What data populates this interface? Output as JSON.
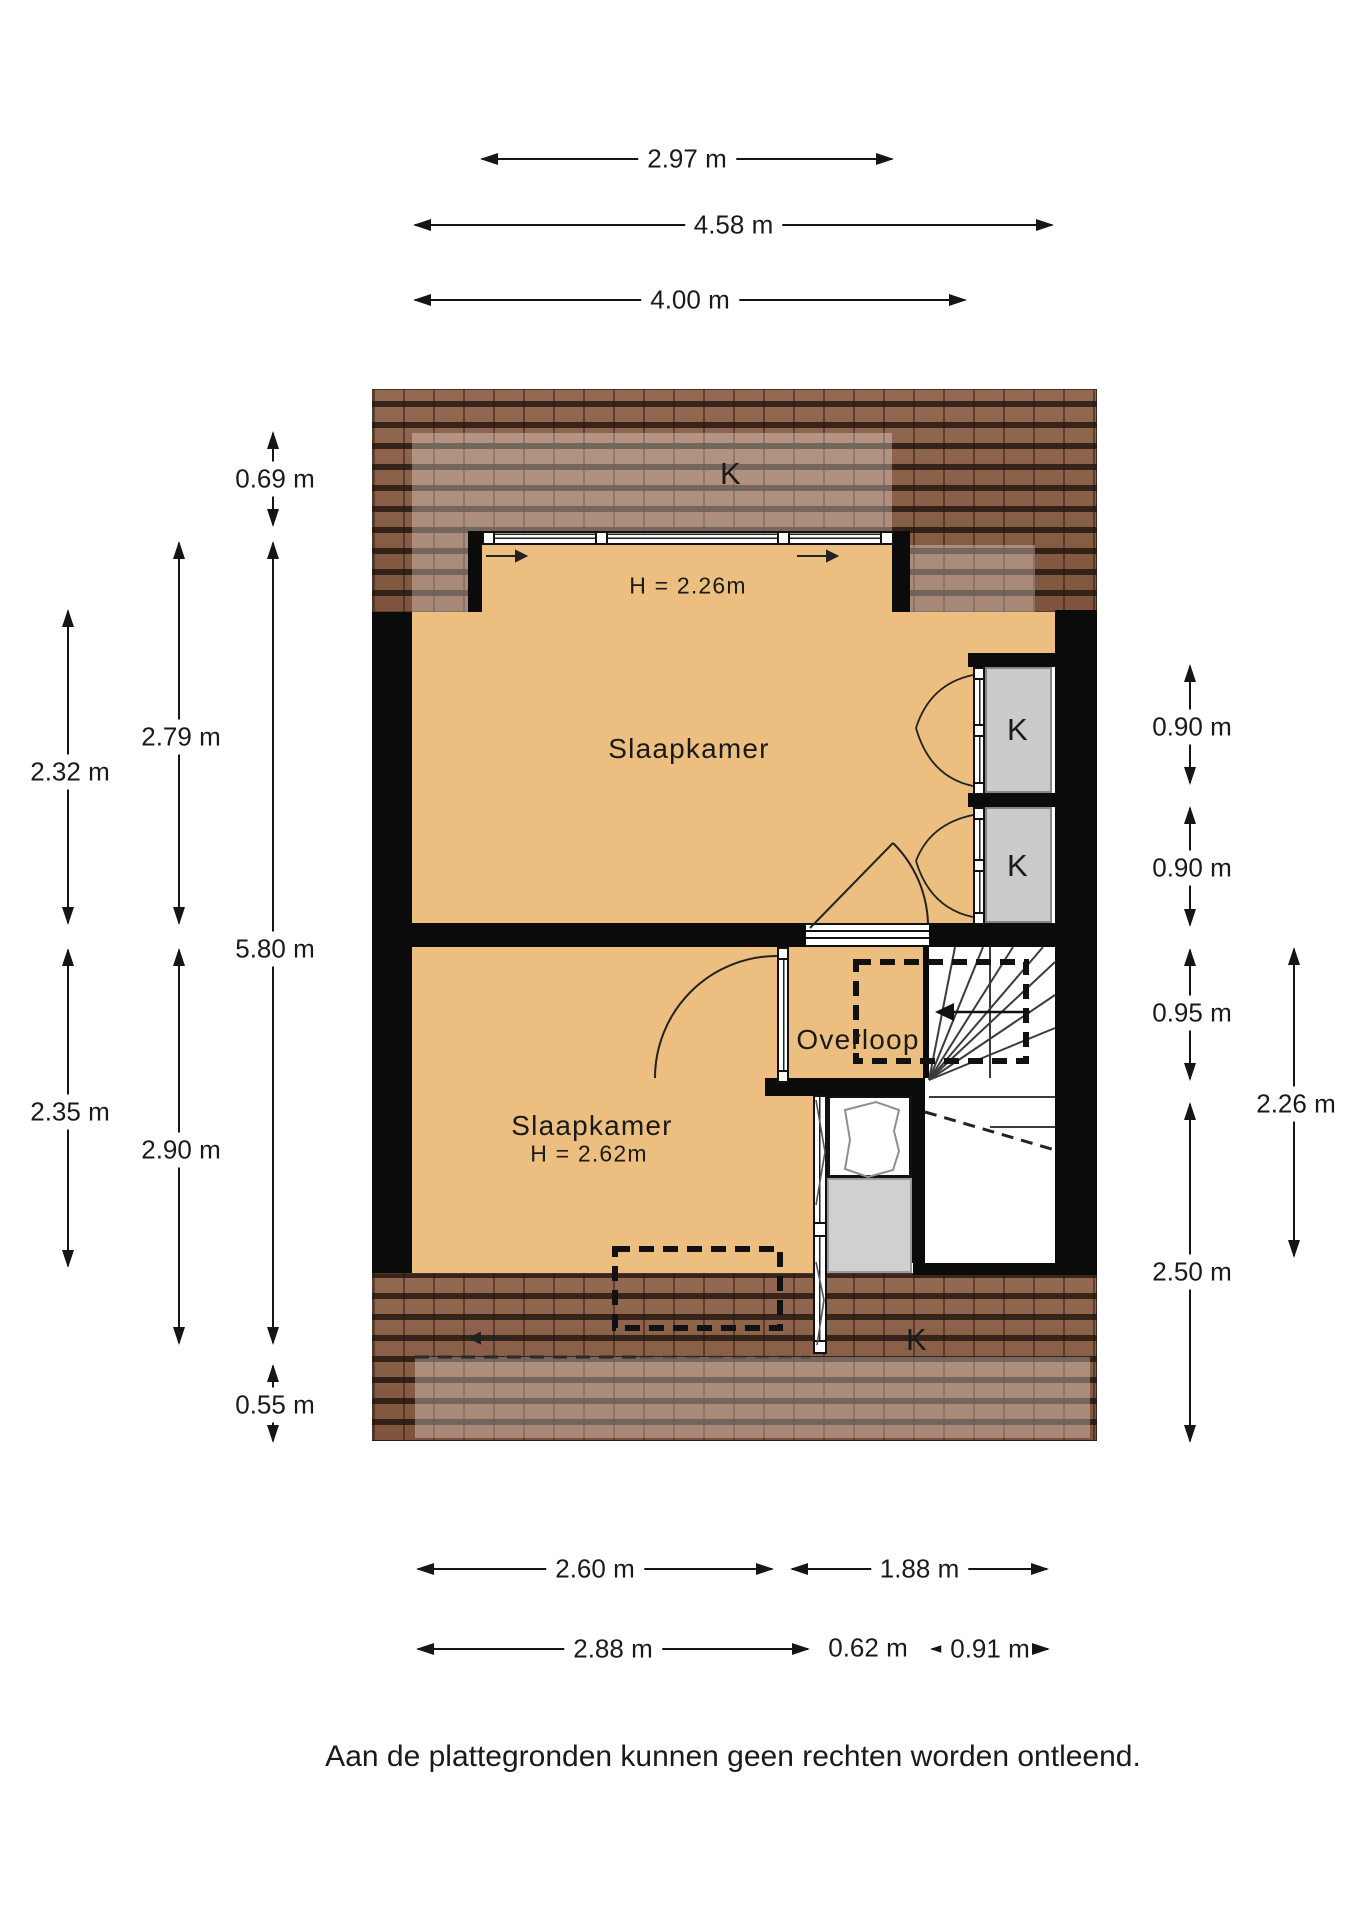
{
  "colors": {
    "room_fill": "#ecbf80",
    "roof_base": "#8c5e44",
    "wall": "#0b0b0b",
    "gray_box": "#cbcbcb",
    "stair_line": "#3c3c3c",
    "dim_color": "#151515",
    "text_color": "#1a1a1a"
  },
  "footer": {
    "text": "Aan de plattegronden kunnen geen rechten worden ontleend."
  },
  "rooms": [
    {
      "name": "Slaapkamer",
      "ceiling_height": "H = 2.26m"
    },
    {
      "name": "Slaapkamer",
      "ceiling_height": "H = 2.62m"
    },
    {
      "name": "Overloop"
    }
  ],
  "texts": [
    {
      "name": "room1-label",
      "text": "Slaapkamer",
      "x": 689,
      "y": 749,
      "size": 28
    },
    {
      "name": "room1-height-label",
      "text": "H = 2.26m",
      "x": 688,
      "y": 586,
      "size": 23
    },
    {
      "name": "room2-label",
      "text": "Slaapkamer",
      "x": 592,
      "y": 1126,
      "size": 28
    },
    {
      "name": "room2-height-label",
      "text": "H = 2.62m",
      "x": 589,
      "y": 1154,
      "size": 23
    },
    {
      "name": "landing-label",
      "text": "Overloop",
      "x": 858,
      "y": 1040,
      "size": 28
    },
    {
      "name": "roof-top-label",
      "text": "K",
      "x": 731,
      "y": 474,
      "size": 31
    },
    {
      "name": "roof-window-1-label",
      "text": "K",
      "x": 1018,
      "y": 730,
      "size": 31
    },
    {
      "name": "roof-window-2-label",
      "text": "K",
      "x": 1018,
      "y": 866,
      "size": 31
    },
    {
      "name": "roof-bottom-label",
      "text": "K",
      "x": 917,
      "y": 1340,
      "size": 31
    }
  ],
  "dimensions": {
    "horizontal": [
      {
        "label": "2.97 m",
        "x1": 482,
        "x2": 892,
        "y": 158
      },
      {
        "label": "4.58 m",
        "x1": 415,
        "x2": 1052,
        "y": 224
      },
      {
        "label": "4.00 m",
        "x1": 415,
        "x2": 965,
        "y": 299
      },
      {
        "label": "2.60 m",
        "x1": 418,
        "x2": 772,
        "y": 1568
      },
      {
        "label": "1.88 m",
        "x1": 792,
        "x2": 1047,
        "y": 1568
      },
      {
        "label": "2.88 m",
        "x1": 418,
        "x2": 808,
        "y": 1648
      },
      {
        "label": "0.91 m",
        "x1": 932,
        "x2": 1048,
        "y": 1648
      }
    ],
    "plain": [
      {
        "label": "0.62 m",
        "x": 868,
        "y": 1648
      }
    ],
    "vertical": [
      {
        "label": "0.69 m",
        "x": 272,
        "y1": 433,
        "y2": 525,
        "label_y": 479
      },
      {
        "label": "2.32 m",
        "x": 67,
        "y1": 611,
        "y2": 923,
        "label_y": 772
      },
      {
        "label": "2.79 m",
        "x": 178,
        "y1": 543,
        "y2": 923,
        "label_y": 737
      },
      {
        "label": "5.80 m",
        "x": 272,
        "y1": 543,
        "y2": 1343,
        "label_y": 949
      },
      {
        "label": "2.35 m",
        "x": 67,
        "y1": 950,
        "y2": 1266,
        "label_y": 1112
      },
      {
        "label": "2.90 m",
        "x": 178,
        "y1": 950,
        "y2": 1343,
        "label_y": 1150
      },
      {
        "label": "0.55 m",
        "x": 272,
        "y1": 1366,
        "y2": 1441,
        "label_y": 1405
      },
      {
        "label": "0.90 m",
        "x": 1189,
        "y1": 666,
        "y2": 783,
        "label_y": 727
      },
      {
        "label": "0.90 m",
        "x": 1189,
        "y1": 808,
        "y2": 925,
        "label_y": 868
      },
      {
        "label": "0.95 m",
        "x": 1189,
        "y1": 950,
        "y2": 1079,
        "label_y": 1013
      },
      {
        "label": "2.50 m",
        "x": 1189,
        "y1": 1104,
        "y2": 1441,
        "label_y": 1272
      },
      {
        "label": "2.26 m",
        "x": 1293,
        "y1": 949,
        "y2": 1256,
        "label_y": 1104
      }
    ]
  }
}
